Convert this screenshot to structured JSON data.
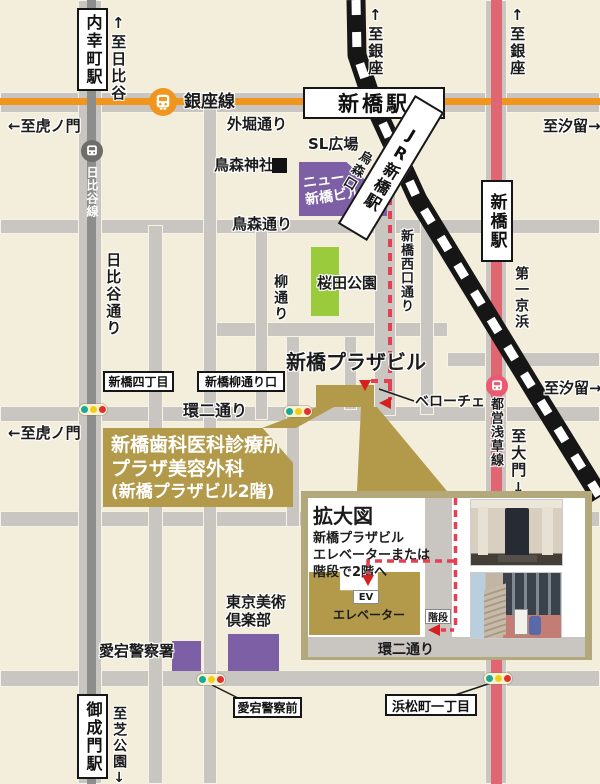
{
  "colors": {
    "background": "#f3eddb",
    "road": "#c9c6c2",
    "jr_line": "#161616",
    "ginza_orange": "#f0961e",
    "asakusa_red": "#e06672",
    "hibiya_gray": "#8d8d8b",
    "route_red": "#e63e52",
    "arrow_red": "#d61f1f",
    "gold": "#b29a4a",
    "purple": "#7d5fa6",
    "park_green": "#9acb3c",
    "inset_frame": "#b3a87b",
    "signal_teal": "#19a89a",
    "signal_yellow": "#f0cf1c",
    "signal_red": "#e03030"
  },
  "stations": {
    "uchisaiwaicho": "内幸町駅",
    "shimbashi_top": "新橋駅",
    "jr_shimbashi": "JR新橋駅",
    "shimbashi_right": "新橋駅",
    "onarimon": "御成門駅"
  },
  "lines": {
    "ginza": "銀座線",
    "hibiya": "日比谷線",
    "asakusa": "都営浅草線"
  },
  "roads": {
    "sotobori": "外堀通り",
    "karasumori_dori": "鳥森通り",
    "hibiya_dori": "日比谷通り",
    "yanagi_dori": "柳通り",
    "nishiguchi_dori": "新橋西口通り",
    "daiichi_keihin": "第一京浜",
    "kanni_dori": "環二通り"
  },
  "directions": {
    "to_hibiya": "↑至日比谷",
    "to_ginza": "↑至銀座",
    "to_shiodome": "至汐留→",
    "to_toranomon": "←至虎ノ門",
    "to_daimon": "至大門↓",
    "to_shibakoen": "至芝公園↓"
  },
  "landmarks": {
    "karasumori_shrine": "鳥森神社",
    "sl_plaza": "SL広場",
    "karasumori_exit": "烏森口",
    "new_shimbashi_line1": "ニュー",
    "new_shimbashi_line2": "新橋ビル",
    "sakurada_park": "桜田公園",
    "plaza_building": "新橋プラザビル",
    "veloce": "ベローチェ",
    "tokyo_art_line1": "東京美術",
    "tokyo_art_line2": "倶楽部",
    "atago_police": "愛宕警察署"
  },
  "intersections": {
    "shimbashi_4chome": "新橋四丁目",
    "yanagidori_guchi": "新橋柳通り口",
    "atago_police_front": "愛宕警察前",
    "hamamatsucho_1chome": "浜松町一丁目"
  },
  "clinic": {
    "line1": "新橋歯科医科診療所",
    "line2": "プラザ美容外科",
    "line3": "(新橋プラザビル2階)"
  },
  "inset": {
    "title": "拡大図",
    "desc1": "新橋プラザビル",
    "desc2": "エレベーターまたは",
    "desc3": "階段で2階へ",
    "ev": "EV",
    "elevator": "エレベーター",
    "stairs": "階段",
    "road": "環二通り"
  },
  "icons": {
    "ginza": "train-icon",
    "hibiya": "train-icon",
    "asakusa": "train-icon",
    "shrine_marker": "black-square-icon",
    "signal": "traffic-light-icon"
  }
}
